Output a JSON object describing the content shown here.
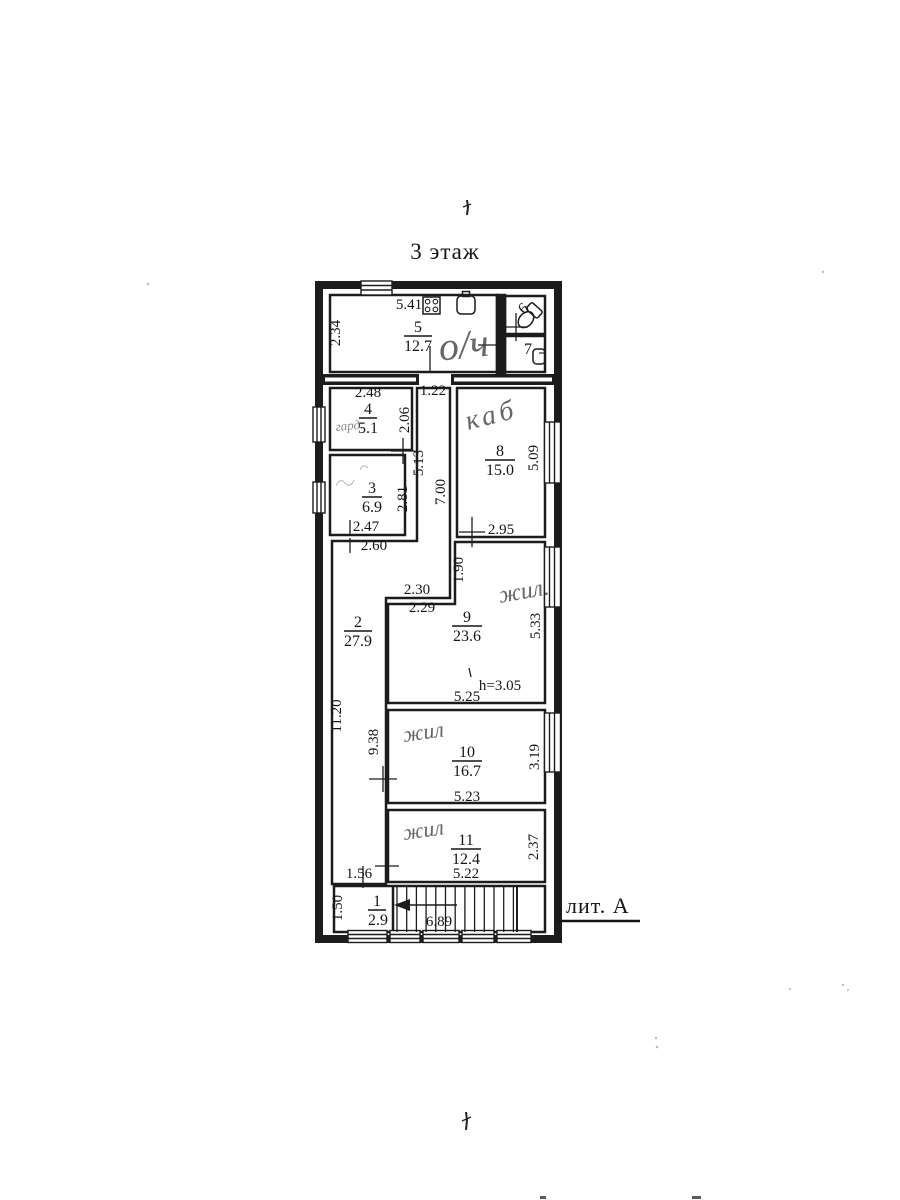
{
  "page": {
    "title": "3 этаж",
    "litera": "лит. А"
  },
  "rooms": {
    "r1": {
      "number": "1",
      "area": "2.9"
    },
    "r2": {
      "number": "2",
      "area": "27.9"
    },
    "r3": {
      "number": "3",
      "area": "6.9"
    },
    "r4": {
      "number": "4",
      "area": "5.1",
      "annotation": "гард."
    },
    "r5": {
      "number": "5",
      "area": "12.7",
      "annotation": "о/ч"
    },
    "r6": {
      "number": "6"
    },
    "r7": {
      "number": "7"
    },
    "r8": {
      "number": "8",
      "area": "15.0",
      "annotation": "каб"
    },
    "r9": {
      "number": "9",
      "area": "23.6",
      "annotation": "жил."
    },
    "r10": {
      "number": "10",
      "area": "16.7",
      "annotation": "жил"
    },
    "r11": {
      "number": "11",
      "area": "12.4",
      "annotation": "жил"
    }
  },
  "dims": {
    "d234": "2.34",
    "d541": "5.41",
    "d248": "2.48",
    "d122": "1.22",
    "d206": "2.06",
    "d513": "5.13",
    "d700": "7.00",
    "d281": "2.81",
    "d247": "2.47",
    "d260": "2.60",
    "d509": "5.09",
    "d295": "2.95",
    "d190": "1.90",
    "d230": "2.30",
    "d229": "2.29",
    "d533": "5.33",
    "d1120": "11.20",
    "d938": "9.38",
    "d525": "5.25",
    "h305": "h=3.05",
    "d523": "5.23",
    "d319": "3.19",
    "d522": "5.22",
    "d237": "2.37",
    "d156": "1.56",
    "d150": "1.50",
    "d689": "6.89"
  }
}
